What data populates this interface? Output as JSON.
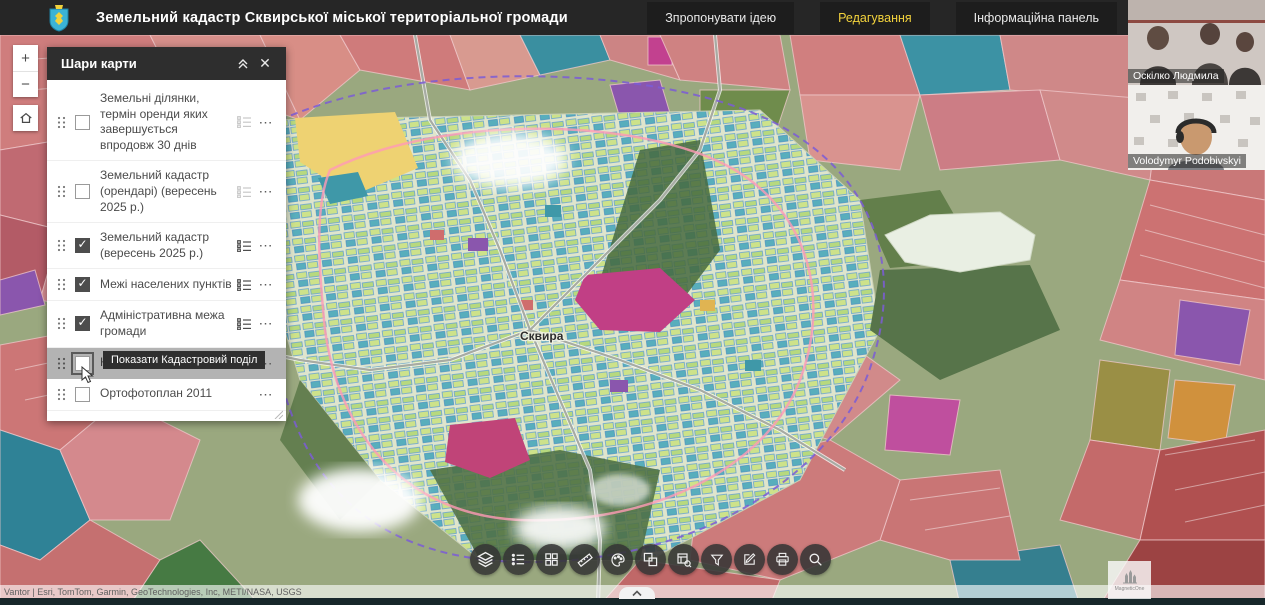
{
  "header": {
    "title": "Земельний кадастр Сквирської міської територіальної громади",
    "menu": [
      {
        "label": "Зпропонувати ідею",
        "active": false
      },
      {
        "label": "Редагування",
        "active": true
      },
      {
        "label": "Інформаційна панель",
        "active": false
      }
    ],
    "accent_color": "#f2d23c",
    "background_color": "#262626"
  },
  "zoom_controls": {
    "zoom_in_label": "+",
    "zoom_out_label": "−",
    "home_icon": "home"
  },
  "layers_panel": {
    "title": "Шари карти",
    "collapse_icon": "double-chevron-up",
    "close_icon": "✕",
    "tooltip": "Показати Кадастровий поділ",
    "layers": [
      {
        "label": "Земельні ділянки, термін оренди яких завершується впродовж 30 днів",
        "checked": false,
        "legend_icon": true,
        "legend_disabled": true
      },
      {
        "label": "Земельний кадастр (орендарі) (вересень 2025 р.)",
        "checked": false,
        "legend_icon": true,
        "legend_disabled": true
      },
      {
        "label": "Земельний кадастр (вересень 2025 р.)",
        "checked": true,
        "legend_icon": true,
        "legend_disabled": false
      },
      {
        "label": "Межі населених пунктів",
        "checked": true,
        "legend_icon": true,
        "legend_disabled": false
      },
      {
        "label": "Адміністративна межа громади",
        "checked": true,
        "legend_icon": true,
        "legend_disabled": false
      },
      {
        "label": "Кадастровий поділ",
        "checked": false,
        "legend_icon": false,
        "highlighted": true
      },
      {
        "label": "Ортофотоплан 2011",
        "checked": false,
        "legend_icon": false
      }
    ],
    "options_icon": "⋯"
  },
  "map": {
    "town_label": "Сквира",
    "attribution": "Vantor | Esri, TomTom, Garmin, GeoTechnologies, Inc, METI/NASA, USGS",
    "palette": {
      "parcel_red": "#c97878",
      "parcel_teal": "#3a8fa0",
      "parcel_purple": "#8a56ad",
      "parcel_magenta": "#c2418f",
      "parcel_yellow": "#eed272",
      "parcel_orange": "#d0913d",
      "forest_green": "#50714a",
      "town_light": "#e2e6d2"
    }
  },
  "toolbar": {
    "tools": [
      {
        "name": "layers"
      },
      {
        "name": "legend"
      },
      {
        "name": "basemap"
      },
      {
        "name": "measure"
      },
      {
        "name": "draw"
      },
      {
        "name": "swipe"
      },
      {
        "name": "query"
      },
      {
        "name": "filter"
      },
      {
        "name": "edit"
      },
      {
        "name": "print"
      },
      {
        "name": "search"
      }
    ]
  },
  "bottom": {
    "expand_icon": "chevron-up"
  },
  "call_overlay": {
    "participants": [
      {
        "name": "Оскілко Людмила"
      },
      {
        "name": "Volodymyr Podobivskyi"
      }
    ]
  },
  "watermark": {
    "text": "MagneticOne"
  }
}
